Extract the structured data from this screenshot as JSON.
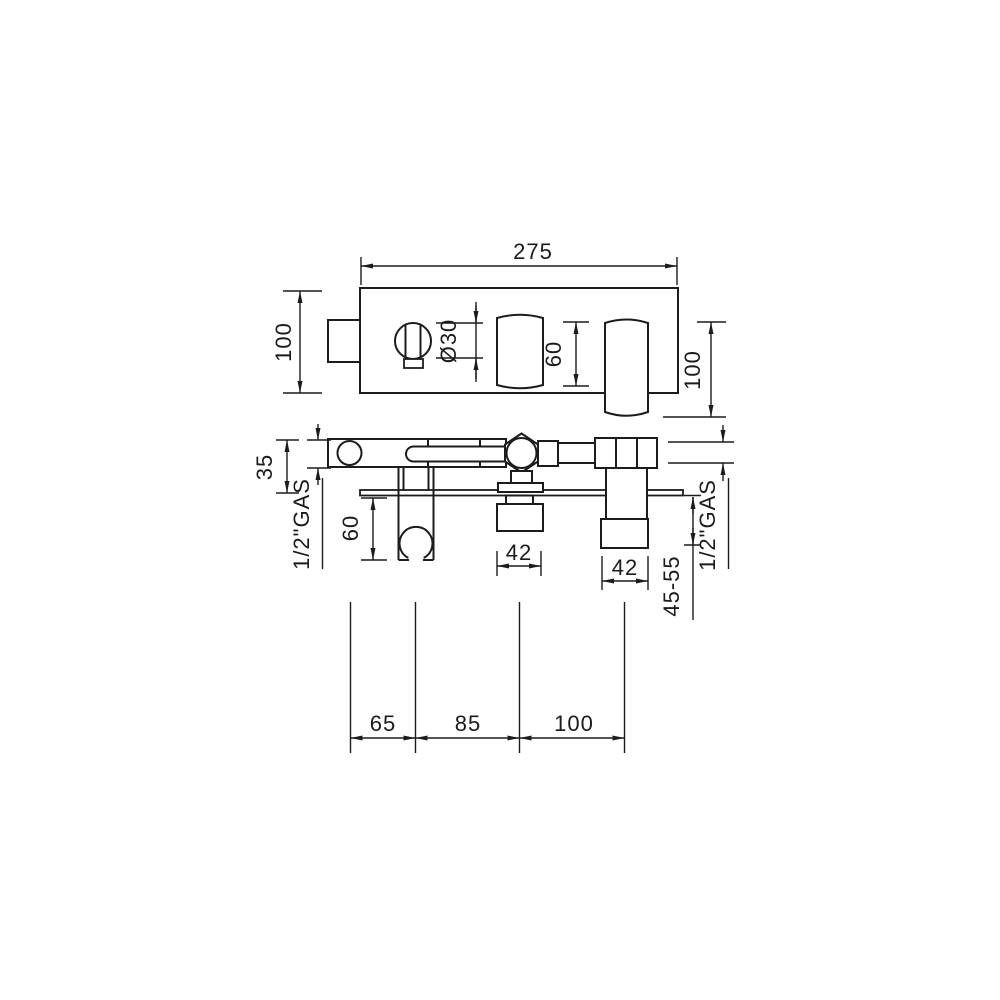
{
  "drawing": {
    "line_color": "#1c1c1c",
    "background": "#ffffff",
    "dims": {
      "plate_width": "275",
      "plate_height": "100",
      "knob_diameter": "Ø30",
      "handle_plate_height": "60",
      "spout_length": "100",
      "body_depth": "35",
      "left_inlet_thread": "1/2\"GAS",
      "holder_drop": "60",
      "center_outlet_width": "42",
      "right_outlet_width": "42",
      "right_outlet_projection": "45-55",
      "right_inlet_thread": "1/2\"GAS",
      "centers_left": "65",
      "centers_middle": "85",
      "centers_right": "100"
    }
  }
}
